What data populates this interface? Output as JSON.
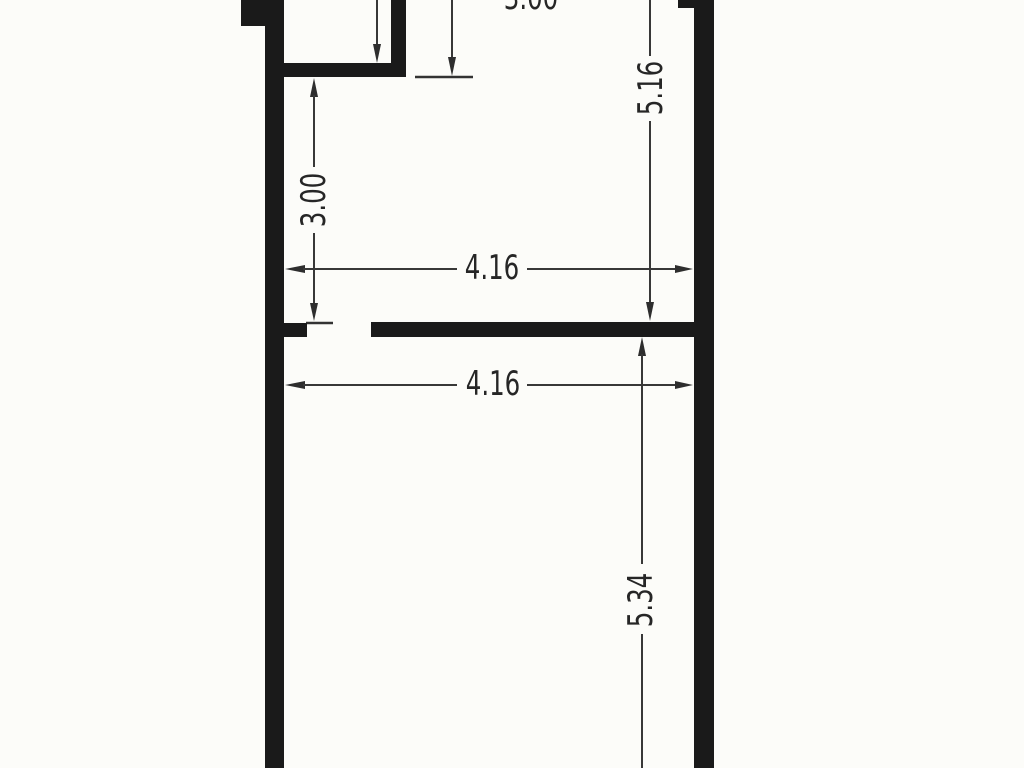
{
  "document": {
    "kind": "scanned floor plan drawing",
    "colors": {
      "paper": "#fcfcf9",
      "wall": "#1a1a1a",
      "dimension_line": "#383838",
      "text": "#262626"
    }
  },
  "dimensions": {
    "top_room_width": "3.00",
    "left_room_height": "3.00",
    "right_upper_height": "5.16",
    "upper_width": "4.16",
    "lower_width": "4.16",
    "right_lower_height": "5.34"
  }
}
